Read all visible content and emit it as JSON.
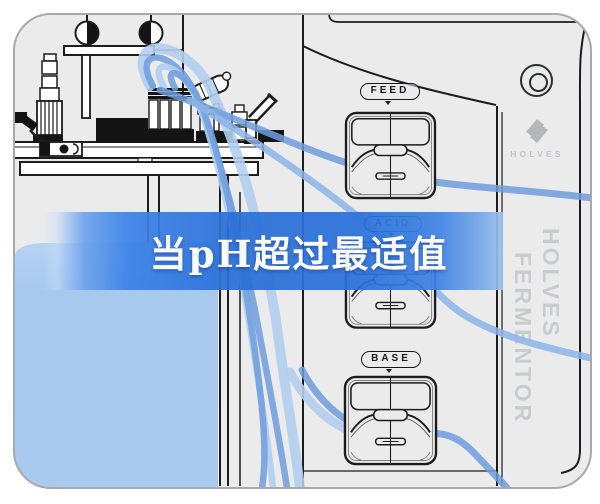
{
  "banner": {
    "text": "当pH超过最适值"
  },
  "panel": {
    "pump_labels": [
      {
        "label": "FEED"
      },
      {
        "label": "ACID"
      },
      {
        "label": "BASE"
      }
    ]
  },
  "brand": {
    "logo_text": "HOLVES",
    "vertical_line1": "HOLVES",
    "vertical_line2": "FERMENTOR"
  },
  "colors": {
    "banner_blue": "#2b70d8",
    "light_blue_block": "#a9c9ee",
    "tube_blue": "#6e9ede",
    "panel_bg": "#ebebec",
    "line_ink": "#1c1c1c",
    "brand_gray": "#c6c9cb"
  }
}
